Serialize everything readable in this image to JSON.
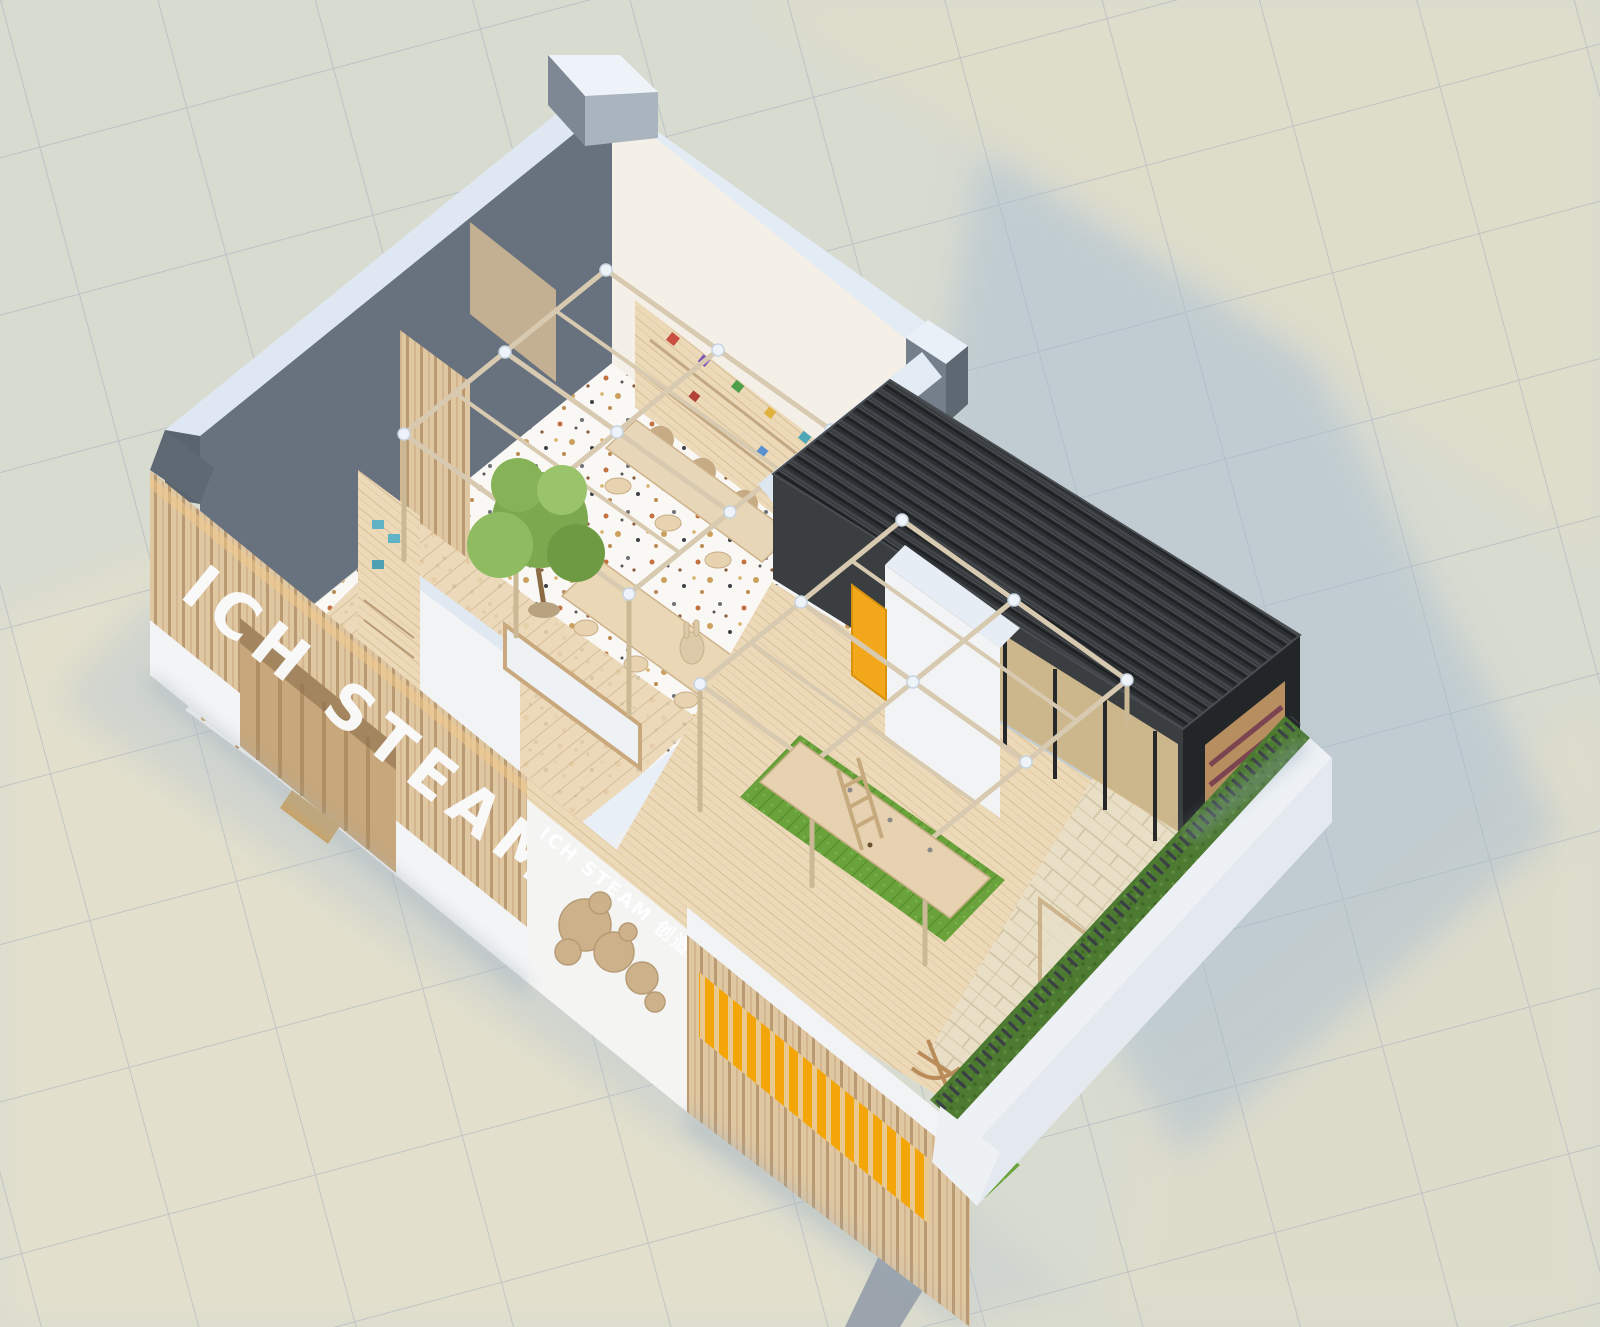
{
  "branding": {
    "slat_wall_logo": "ICH STEAM",
    "front_wall_logo": "ICH STEAM 创造力工坊",
    "front_wall_logo_en": "ICH STEAM",
    "front_wall_logo_zh": "创造力工坊"
  },
  "scene": {
    "view": "isometric-cutaway-3d-render",
    "areas": {
      "classroom": "wood shelving with toys, terrazzo floor, work desks",
      "atrium": "gabled timber frame with tree and work tables",
      "outdoor_deck": "gabled timber frame over work table on turf rug",
      "annex": "dark charred-wood volume with glazed front",
      "entrance": "arched timber alcove in slat facade"
    }
  },
  "palette": {
    "ground_tile": "#d8dbd0",
    "grid_line": "#a3afbd",
    "ground_warm": "#efe5c9",
    "ground_shadow": "#a9bed2",
    "wall_top_band": "#e3ebf4",
    "wall_inner_dark": "#68727e",
    "wall_white": "#f3f4f5",
    "wood_light": "#ecd9b8",
    "wood_slat": "#dfc7a2",
    "annex_dark": "#2e3133",
    "turf_green": "#6aa23c",
    "hedge_green": "#4d7a31",
    "awning_yellow": "#f4a608",
    "tree_green": "#7ca94f",
    "terrazzo_base": "#faf8f4",
    "frame_joint_white": "#eef3f9"
  }
}
